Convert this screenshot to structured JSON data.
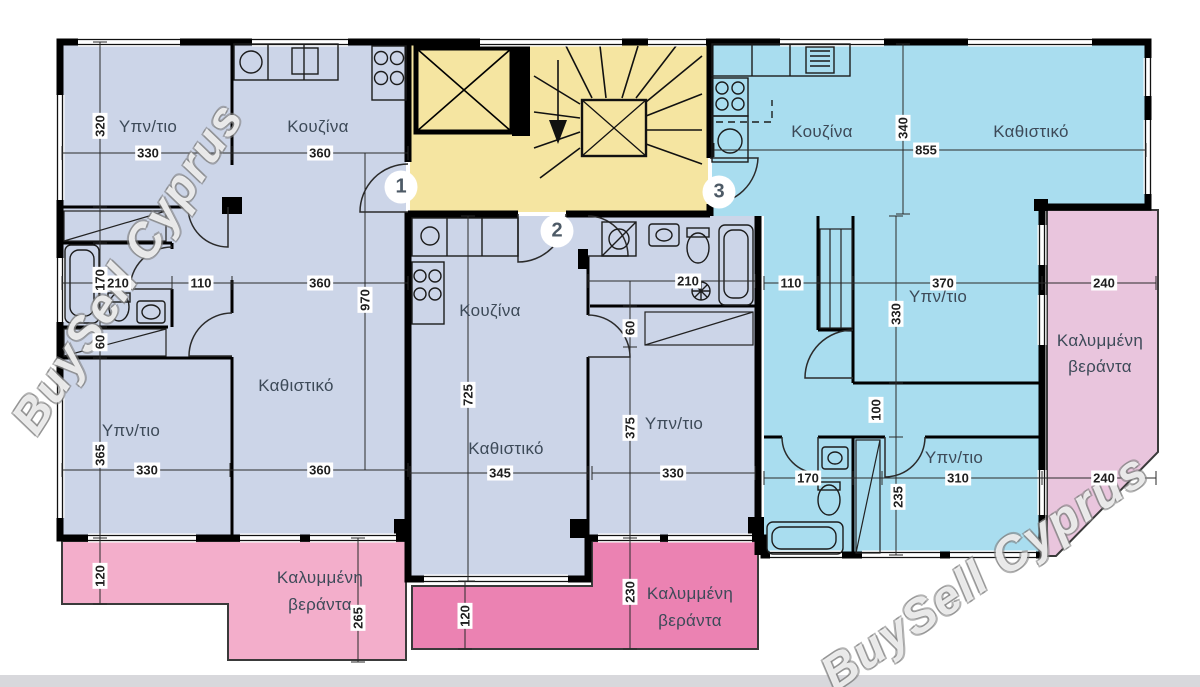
{
  "watermark": "BuySell Cyprus",
  "colors": {
    "apartment_blue": "#ccd5e8",
    "apartment_cyan": "#a9ddef",
    "stairwell_yellow": "#f5e5a1",
    "veranda_pink_light": "#f3aecb",
    "veranda_pink_dark": "#eb82b2",
    "veranda_mauve": "#e9c5dd"
  },
  "apartments": {
    "apt1": {
      "number": "1",
      "bedroom_top": "Υπν/τιο",
      "kitchen": "Κουζίνα",
      "living": "Καθιστικό",
      "bedroom_bottom": "Υπν/τιο"
    },
    "apt2": {
      "number": "2",
      "kitchen": "Κουζίνα",
      "living": "Καθιστικό",
      "bedroom": "Υπν/τιο"
    },
    "apt3": {
      "number": "3",
      "kitchen": "Κουζίνα",
      "living": "Καθιστικό",
      "bedroom_top": "Υπν/τιο",
      "bedroom_bottom": "Υπν/τιο"
    }
  },
  "verandas": {
    "line1": "Καλυμμένη",
    "line2": "βεράντα"
  },
  "dims": {
    "apt1": {
      "bed_top_h": "320",
      "bed_top_w": "330",
      "kitchen_w": "360",
      "bath_h": "170",
      "bath_w": "210",
      "hall_w": "110",
      "living_w": "360",
      "living_h": "970",
      "closet_h": "60",
      "bed_bot_h": "365",
      "bed_bot_w": "330",
      "living_w_bottom": "360"
    },
    "apt2": {
      "living_w": "345",
      "living_h": "725",
      "bath_w": "210",
      "closet_h": "60",
      "bed_h": "375",
      "bed_w": "330"
    },
    "apt3": {
      "kitchen_h": "340",
      "width": "855",
      "hall_w": "110",
      "bed_top_w": "370",
      "bed_top_h": "330",
      "corridor_h": "100",
      "wc_w": "170",
      "wc_h": "235",
      "bed_bot_w": "310"
    },
    "verandas": {
      "right_top": "240",
      "right_bottom": "240",
      "left_strip": "120",
      "left_h": "265",
      "mid_h": "230",
      "mid_strip": "120"
    }
  }
}
